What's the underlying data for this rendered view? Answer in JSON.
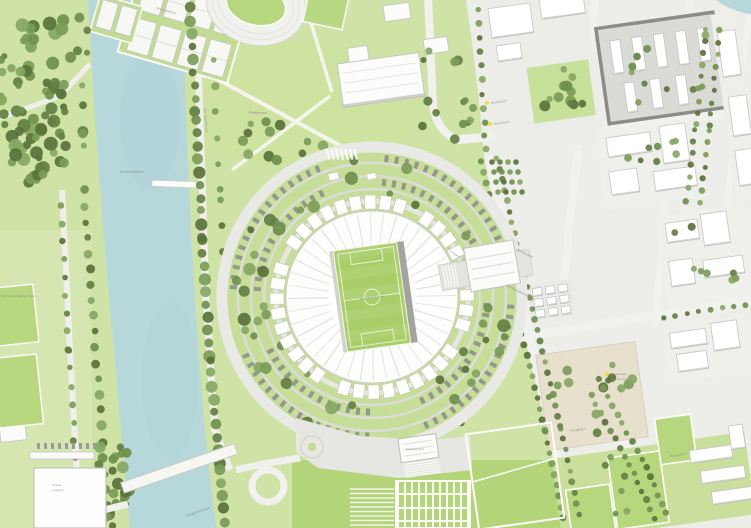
{
  "colors": {
    "water": "#b7d8db",
    "lawn": "#cfe3a6",
    "lawn_bright": "#b4d479",
    "pitch": "#a9ce69",
    "tree": "#6f8f4d",
    "street": "#f1f1ed",
    "building": "#ffffff",
    "city_ground": "#edede9",
    "plaza_beige": "#e6e0cc",
    "label": "#8c8c88",
    "pin_yellow": "#f1de3c"
  },
  "labels": [
    {
      "name": "stadium",
      "text": "Red Bull Arena"
    },
    {
      "name": "water-basin",
      "text": "Elsterbecken"
    },
    {
      "name": "meadow",
      "text": "Festwiese"
    },
    {
      "name": "tennis-courts",
      "text": "Tennisplätze"
    },
    {
      "name": "road-west",
      "text": "Am Sportforum"
    },
    {
      "name": "street-east",
      "text": "Waldstraße"
    },
    {
      "name": "district-east",
      "text": "Waldstraßenviertel"
    },
    {
      "name": "bridge",
      "text": "Zeppelinbrücke"
    },
    {
      "name": "hall-line1",
      "text": "Arena"
    },
    {
      "name": "hall-line2",
      "text": "Leipzig"
    },
    {
      "name": "fair-square",
      "text": "Festplatz"
    },
    {
      "name": "park-west",
      "text": "Richard-Wagner-Hain"
    },
    {
      "name": "tram-stop-1",
      "text": "Haltestelle"
    },
    {
      "name": "tram-stop-2",
      "text": "Haltestelle"
    },
    {
      "name": "tram-stop-3a",
      "text": "Haltestelle"
    },
    {
      "name": "tram-stop-3b",
      "text": "Sportforum"
    },
    {
      "name": "sports-fields",
      "text": "Sportplätze"
    },
    {
      "name": "gate-south",
      "text": "Eingang Süd"
    },
    {
      "name": "gate-east",
      "text": "Eingang Ost"
    }
  ]
}
